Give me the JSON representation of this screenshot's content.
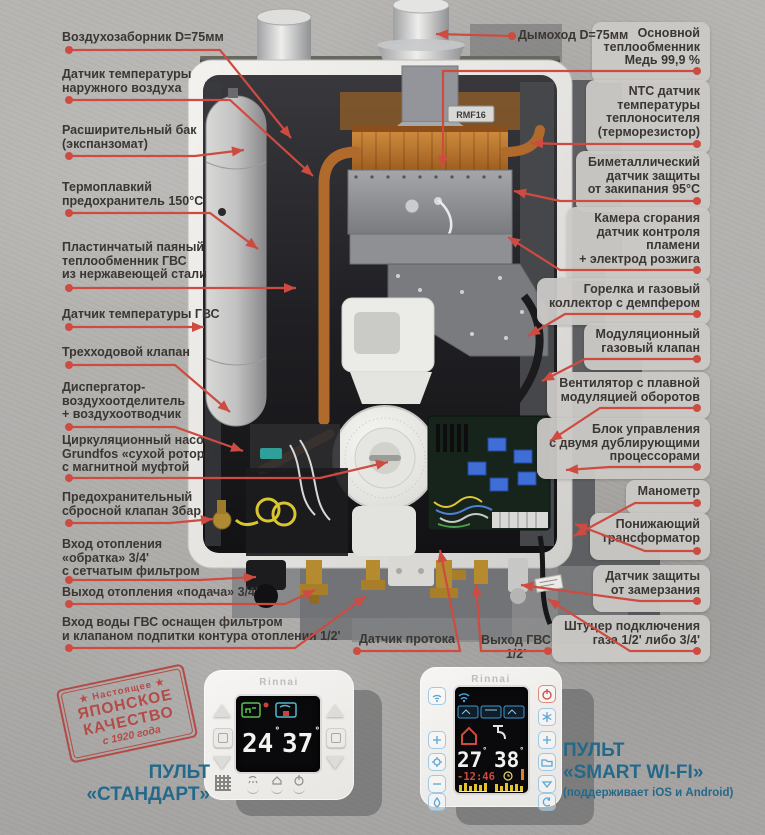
{
  "boiler": {
    "flue_label": "Дымоход D=75мм",
    "left_labels": [
      "Воздухозаборник D=75мм",
      "Датчик температуры\nнаружного воздуха",
      "Расширительный бак\n(экспанзомат)",
      "Термоплавкий\nпредохранитель 150°С",
      "Пластинчатый паяный\nтеплообменник ГВС\nиз нержавеющей стали",
      "Датчик температуры ГВС",
      "Трехходовой клапан",
      "Диспергатор-\nвоздухоотделитель\n+ воздухоотводчик",
      "Циркуляционный насос\nGrundfos «сухой ротор»\nс магнитной муфтой",
      "Предохранительный\nсбросной клапан 3бар",
      "Вход отопления\n«обратка» 3/4'\nс сетчатым фильтром",
      "Выход отопления «подача» 3/4'",
      "Вход воды ГВС оснащен фильтром\nи клапаном подпитки контура отопления 1/2'"
    ],
    "right_labels": [
      "Основной\nтеплообменник\nМедь 99,9 %",
      "NTC датчик\nтемпературы\nтеплоносителя\n(терморезистор)",
      "Биметаллический\nдатчик защиты\nот закипания 95°С",
      "Камера сгорания\nдатчик контроля\nпламени\n+ электрод розжига",
      "Горелка и газовый\nколлектор с демпфером",
      "Модуляционный\nгазовый клапан",
      "Вентилятор с плавной\nмодуляцией оборотов",
      "Блок управления\nс двумя дублирующими\nпроцессорами",
      "Манометр",
      "Понижающий\nтрансформатор",
      "Датчик защиты\nот замерзания",
      "Штуцер подключения\nгаза 1/2' либо 3/4'"
    ],
    "bottom_labels": [
      "Датчик протока",
      "Выход ГВС 1/2'"
    ],
    "marking": "RMF16"
  },
  "stamp": {
    "top": "★ Настоящее ★",
    "word1": "ЯПОНСКОЕ",
    "word2": "КАЧЕСТВО",
    "bottom": "с 1920 года"
  },
  "remote_standard": {
    "brand": "Rinnai",
    "temp_heating": "24",
    "temp_dhw": "37",
    "caption1": "ПУЛЬТ",
    "caption2": "«СТАНДАРТ»"
  },
  "remote_smart": {
    "brand": "Rinnai",
    "temp_heating": "27",
    "temp_dhw": "38",
    "time": "-12:46",
    "caption1": "ПУЛЬТ",
    "caption2": "«SMART WI-FI»",
    "caption3": "(поддерживает iOS и Android)"
  },
  "colors": {
    "leader_red": "#cd4b41",
    "label_text": "#3a3633",
    "caption_teal": "#24688a",
    "stamp_red": "#b5413c",
    "chip_bg": "#cbc9c6"
  }
}
